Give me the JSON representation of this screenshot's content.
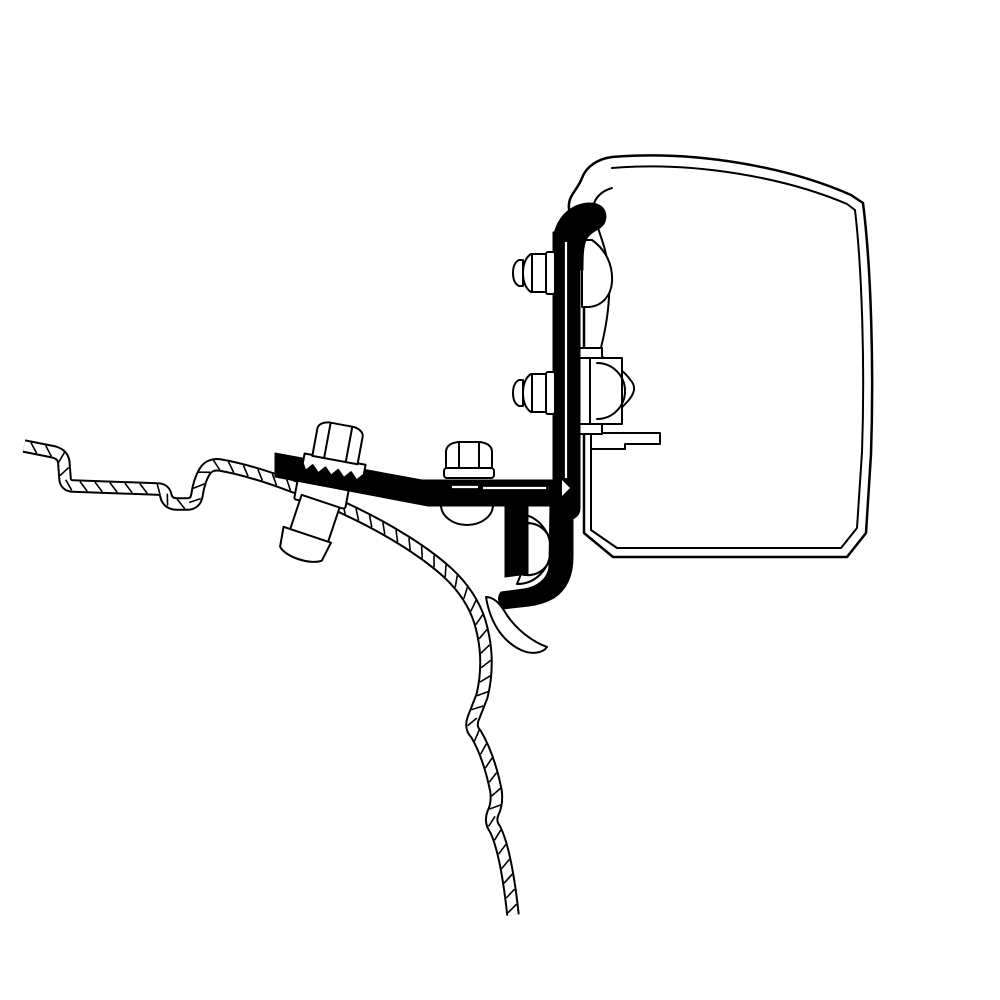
{
  "diagram": {
    "title": "Awning mount adapter bracket - technical cross-section diagram",
    "background_color": "#ffffff",
    "line_color": "#000000",
    "fill_color": "#ffffff",
    "parts": {
      "cassette": {
        "label": "awning cassette profile (double-line contour)"
      },
      "cassette_hook": {
        "label": "cassette top hook channel"
      },
      "channel_lobe": {
        "label": "upper T-slot channel lobe"
      },
      "channel_nut": {
        "label": "lower T-slot channel nut with arc"
      },
      "adapter_plate": {
        "label": "vertical adapter mounting plate"
      },
      "top_hook": {
        "label": "adapter top hook engaging cassette"
      },
      "cap_nut_upper": {
        "label": "upper dome cap nut with flange washer"
      },
      "cap_nut_lower": {
        "label": "lower dome cap nut with flange washer"
      },
      "bracket_arm": {
        "label": "horizontal adapter bracket arm"
      },
      "j_hook": {
        "label": "J-hook clamp strips"
      },
      "clamp_bolt": {
        "label": "center hex clamp bolt with washer and spacer"
      },
      "roof_bolt": {
        "label": "roof hex bolt with serrated lock washer"
      },
      "spacer_sleeve": {
        "label": "spacer sleeve through roof panel"
      },
      "roof_panel": {
        "label": "vehicle roof sheet-metal cross-section (hatched)"
      },
      "rail_profile": {
        "label": "roof rail bracket profile curves"
      }
    }
  }
}
